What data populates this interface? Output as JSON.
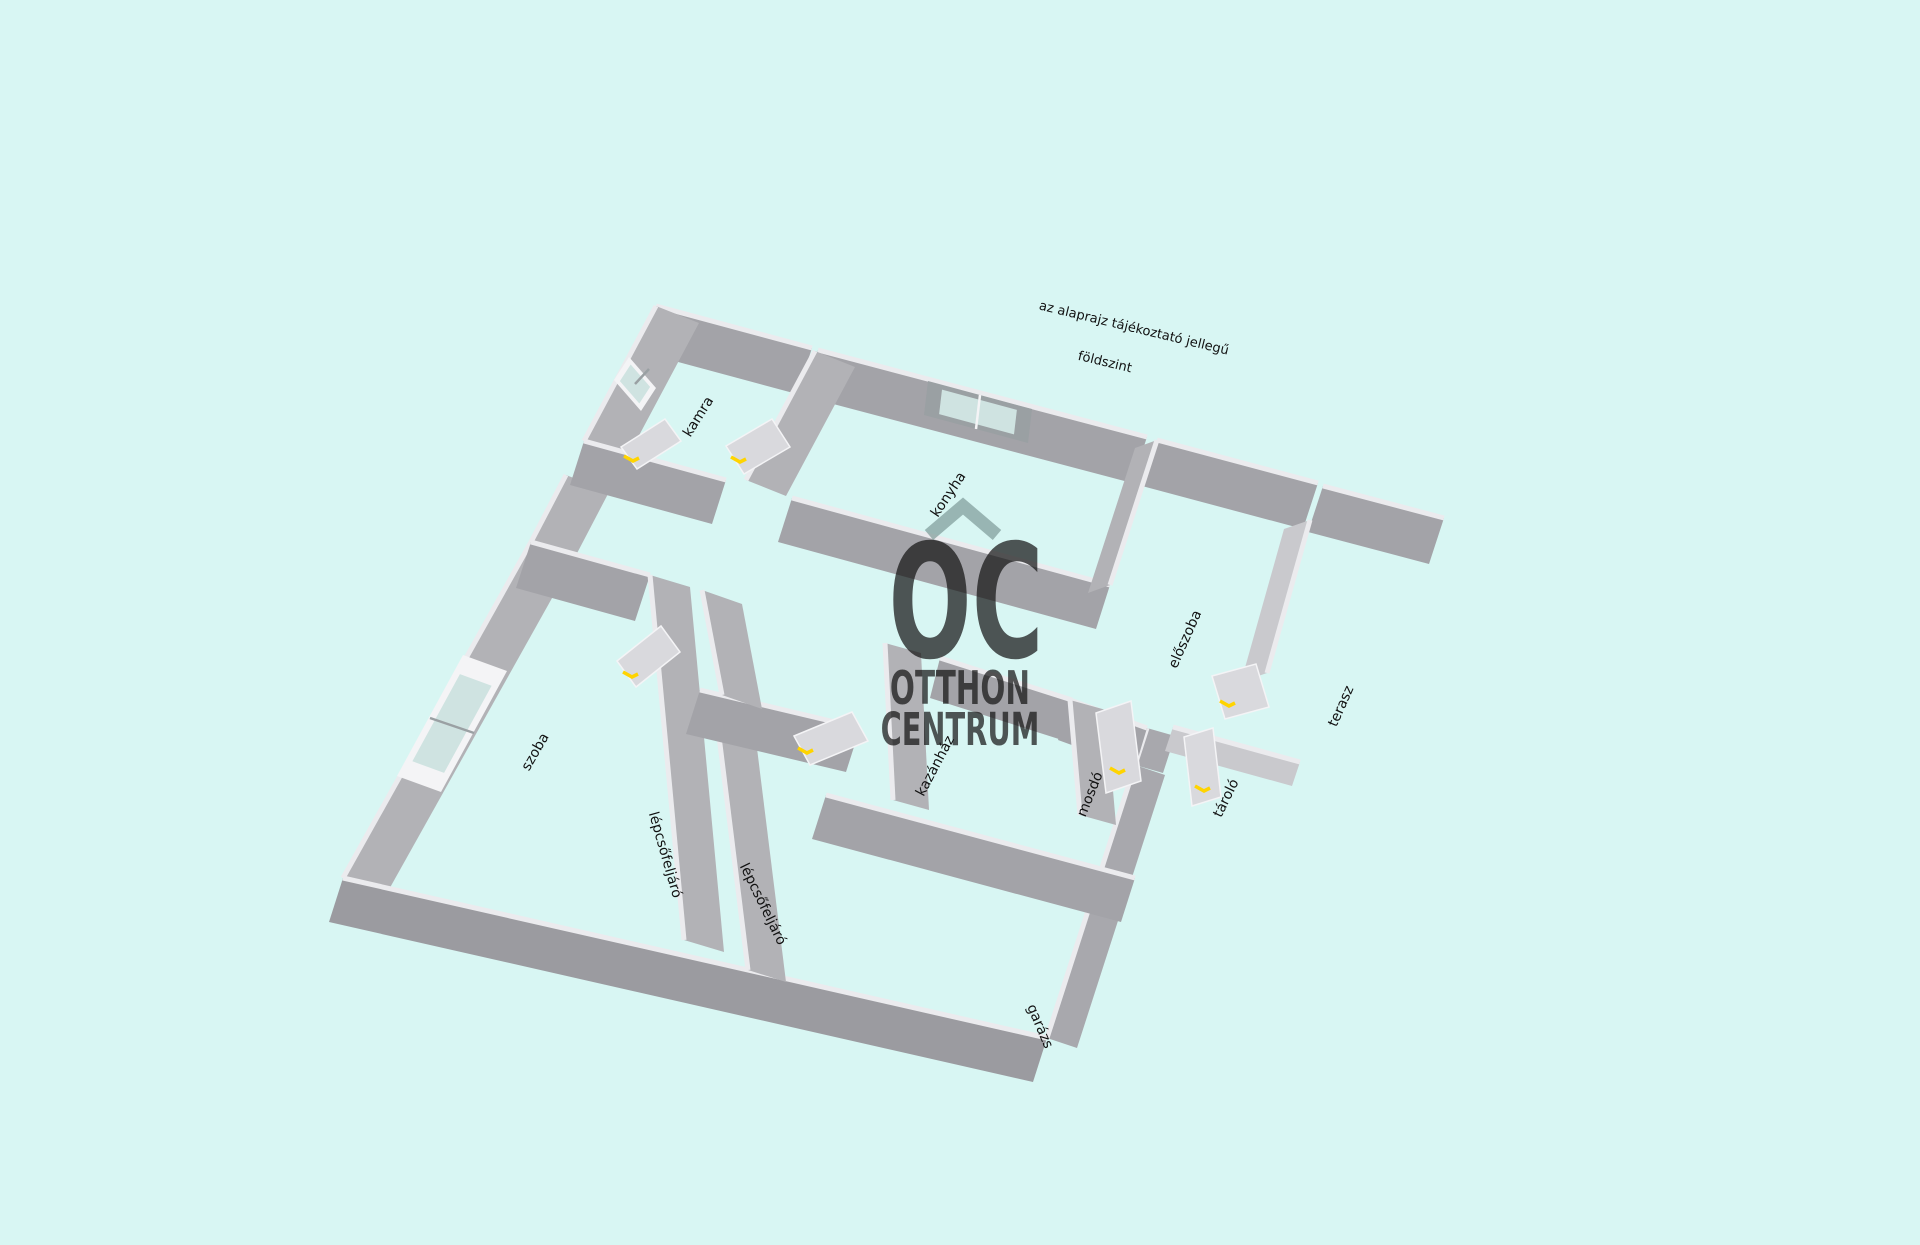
{
  "titles": {
    "disclaimer": "az alaprajz tájékoztató jellegű",
    "floor": "földszint"
  },
  "watermark": {
    "monogram": "OC",
    "line1": "OTTHON",
    "line2": "CENTRUM",
    "icon": "roof-chevron-icon"
  },
  "rooms": {
    "kamra": "kamra",
    "konyha": "konyha",
    "eloszoba": "előszoba",
    "terasz": "terasz",
    "szoba": "szoba",
    "lepcso1": "lépcsőfeljáró",
    "lepcso2": "lépcsőfeljáró",
    "kazanhaz": "kazánház",
    "mosdo": "mosdó",
    "tarolo": "tároló",
    "garazs": "garázs"
  },
  "colors": {
    "background": "#d8f6f3",
    "wall_u": "#a3a3a8",
    "wall_v": "#b2b2b6",
    "wall_south": "#9b9ba0",
    "wall_east": "#a8a8ad",
    "wall_light": "#c9c9cd",
    "ridge": "#ebebee",
    "door": "#d9d9dd",
    "door_edge": "#f4f4f6",
    "handle": "#ffd400",
    "window_frame": "#f4f4f6",
    "window_frame_dark": "#9aa0a3",
    "window_glass": "#cfe3e1",
    "watermark": "#7e9a97",
    "label_text": "#111111"
  }
}
